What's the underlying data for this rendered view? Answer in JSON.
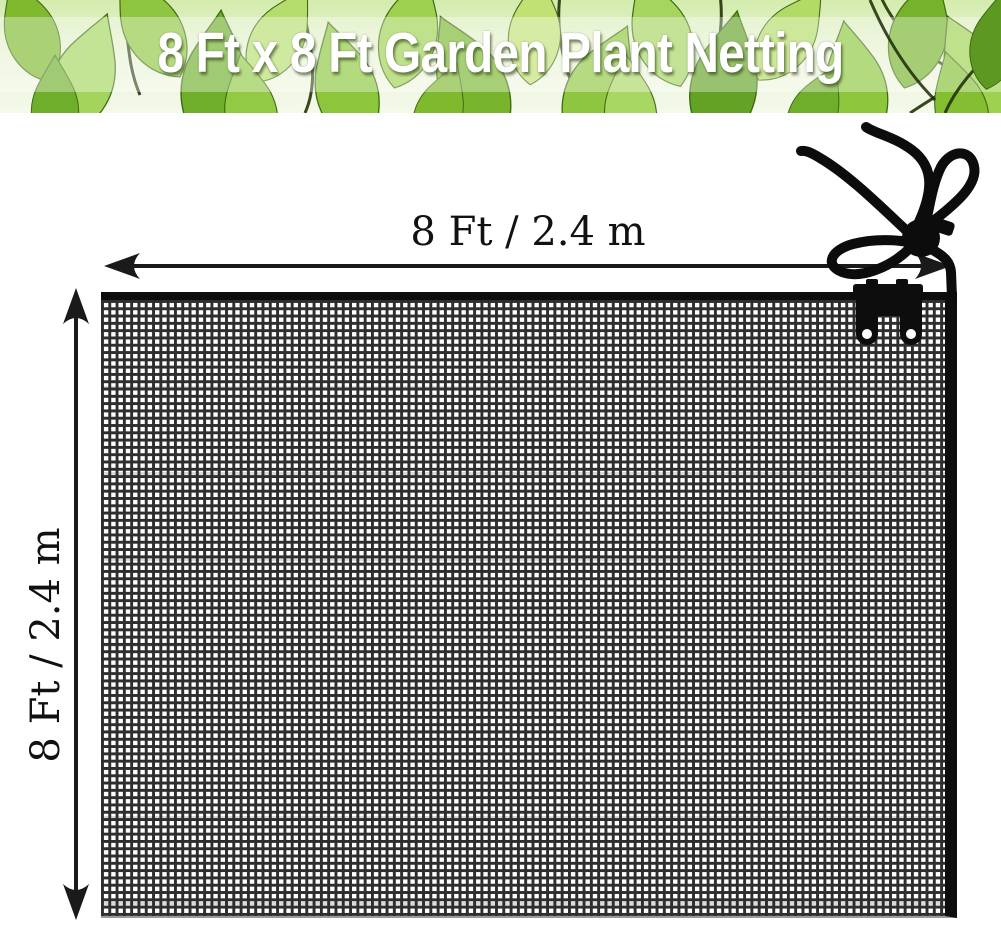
{
  "banner": {
    "title": "8 Ft x 8 Ft Garden Plant Netting",
    "text_color": "#ffffff",
    "background": "green-leaves-photo"
  },
  "dimensions": {
    "width_label": "8 Ft / 2.4 m",
    "height_label": "8 Ft / 2.4 m"
  },
  "graphics": {
    "net": "netting-mesh",
    "cord": "drawstring-cord",
    "toggle": "cord-lock-toggle",
    "clips": "net-clips"
  },
  "colors": {
    "mesh_line": "#2e2e2e",
    "net_border": "#0d0d0d",
    "cord": "#0c0c0c",
    "arrow": "#1a1a1a",
    "banner_text": "#ffffff"
  }
}
